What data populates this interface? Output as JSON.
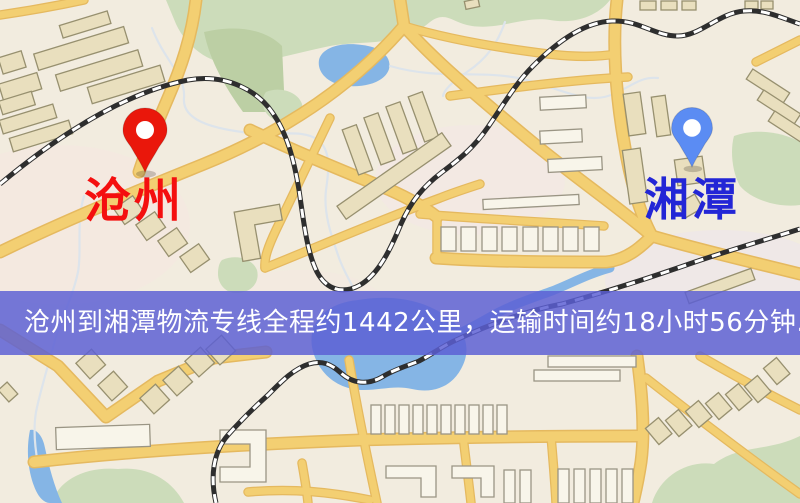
{
  "image": {
    "width": 800,
    "height": 503,
    "kind": "logistics-route-map"
  },
  "markers": {
    "origin": {
      "name": "沧州",
      "pin": "red-map-pin"
    },
    "destination": {
      "name": "湘潭",
      "pin": "blue-map-pin"
    }
  },
  "caption": {
    "text": "沧州到湘潭物流专线全程约1442公里，运输时间约18小时56分钟.",
    "origin": "沧州",
    "destination": "湘潭",
    "distance": "1442公里",
    "duration": "18小时56分钟"
  },
  "colors": {
    "origin_pin": "#ea170b",
    "origin_label": "#f40f0f",
    "destination_pin": "#5b8cf3",
    "destination_label": "#2326d6",
    "caption_bg": "#5c5fd4",
    "caption_text": "#ffffff",
    "map_bg": "#f2ecdf",
    "road": "#f3cf72",
    "road_casing": "#e5b95f",
    "rail": "#2e2e2e",
    "water": "#85b5e5",
    "park": "#ccdcba",
    "building": "#e9dfbe",
    "building_outline": "#97906f"
  }
}
